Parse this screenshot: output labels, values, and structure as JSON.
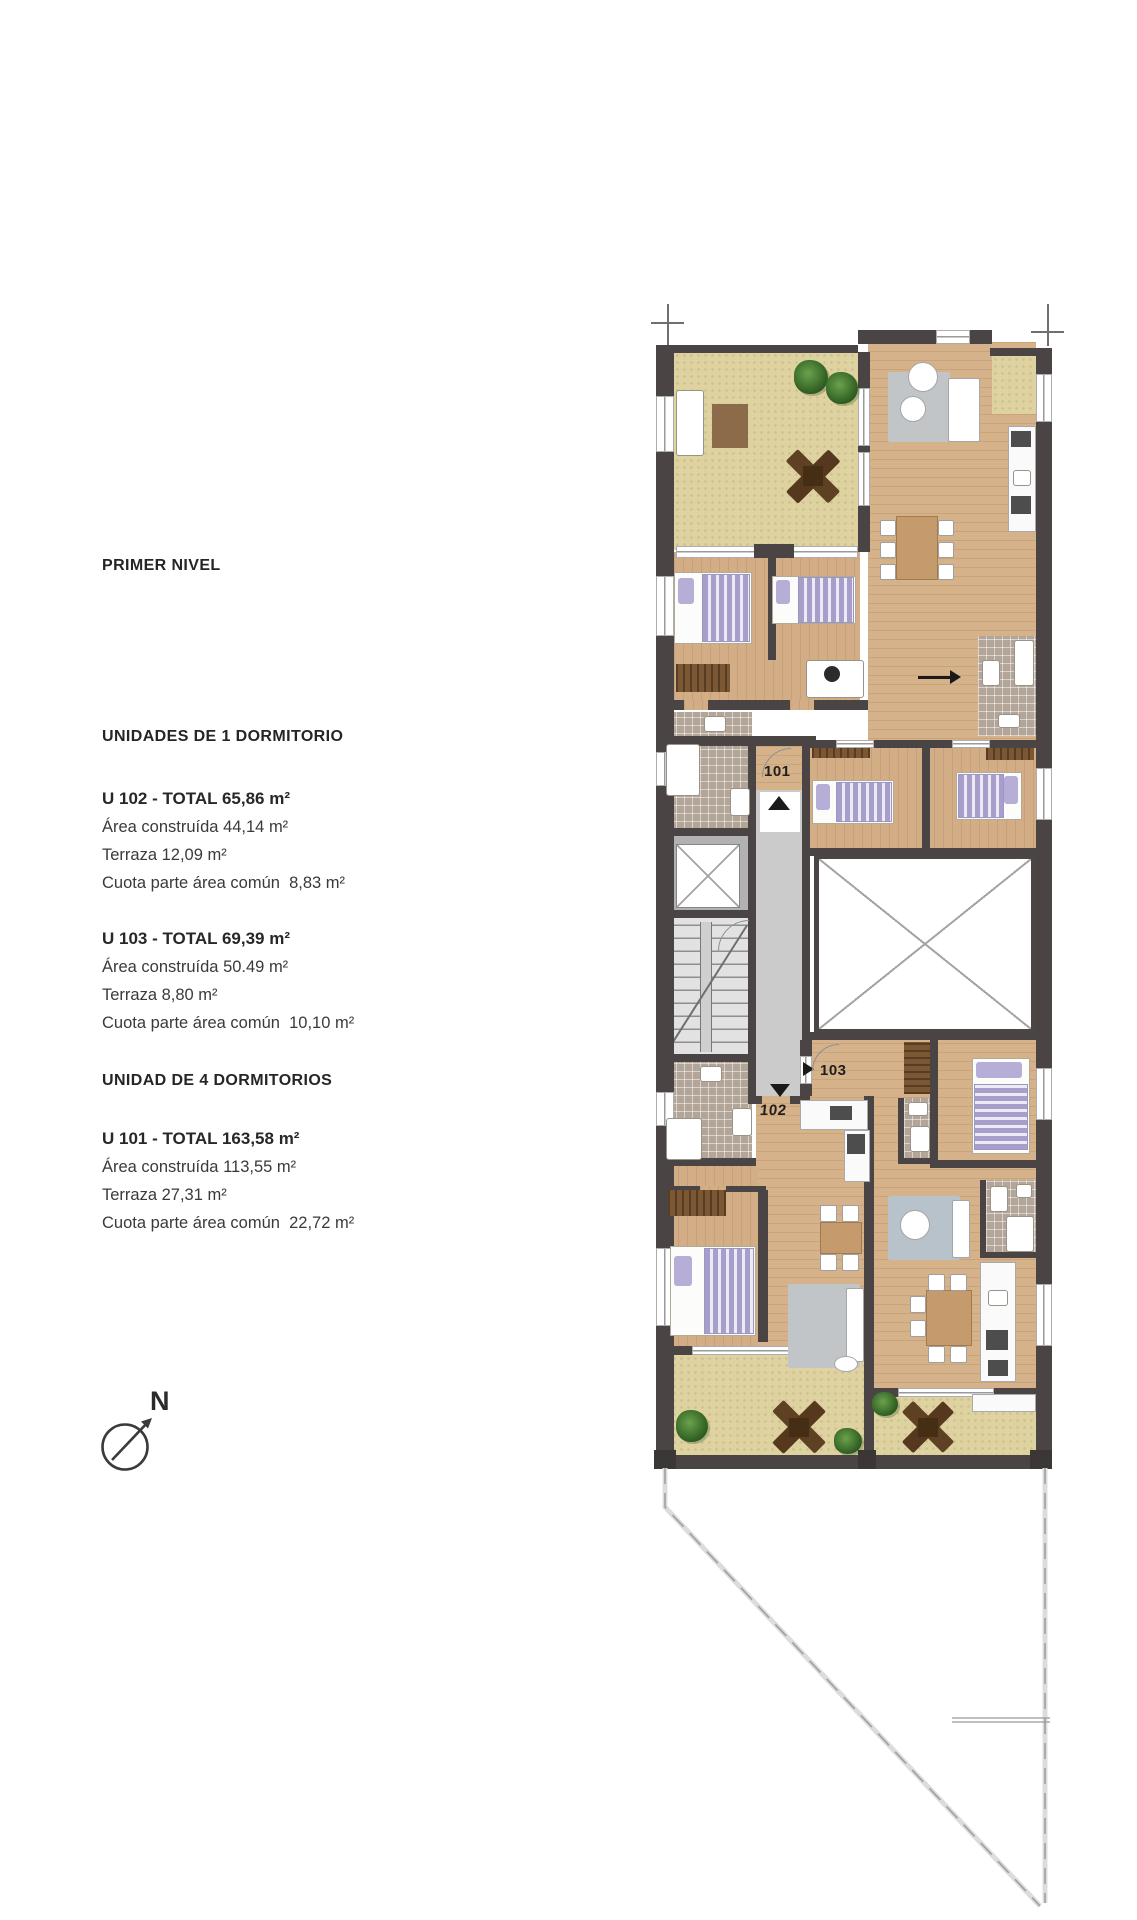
{
  "page": {
    "title": "PRIMER NIVEL"
  },
  "sections": {
    "one_bedroom": {
      "header": "UNIDADES DE 1 DORMITORIO",
      "units": [
        {
          "title": "U 102 - TOTAL 65,86 m²",
          "lines": [
            "Área construída 44,14 m²",
            "Terraza 12,09 m²",
            "Cuota parte área común  8,83 m²"
          ]
        },
        {
          "title": "U 103 - TOTAL 69,39 m²",
          "lines": [
            "Área construída 50.49 m²",
            "Terraza 8,80 m²",
            "Cuota parte área común  10,10 m²"
          ]
        }
      ]
    },
    "four_bedroom": {
      "header": "UNIDAD DE 4 DORMITORIOS",
      "units": [
        {
          "title": "U 101 - TOTAL 163,58 m²",
          "lines": [
            "Área construída 113,55 m²",
            "Terraza 27,31 m²",
            "Cuota parte área común  22,72 m²"
          ]
        }
      ]
    }
  },
  "compass": {
    "label": "N"
  },
  "plan": {
    "unit_labels": {
      "u101": "101",
      "u102": "102",
      "u103": "103"
    }
  },
  "palette": {
    "wall": "#4a4544",
    "wood_floor": "#d6b28a",
    "terrace_sand": "#ddd2a0",
    "bath_tile": "#b3a598",
    "textile_accent": "#a79ecb",
    "plan_line_gray": "#9f9f9f",
    "text": "#2c2c2c"
  }
}
